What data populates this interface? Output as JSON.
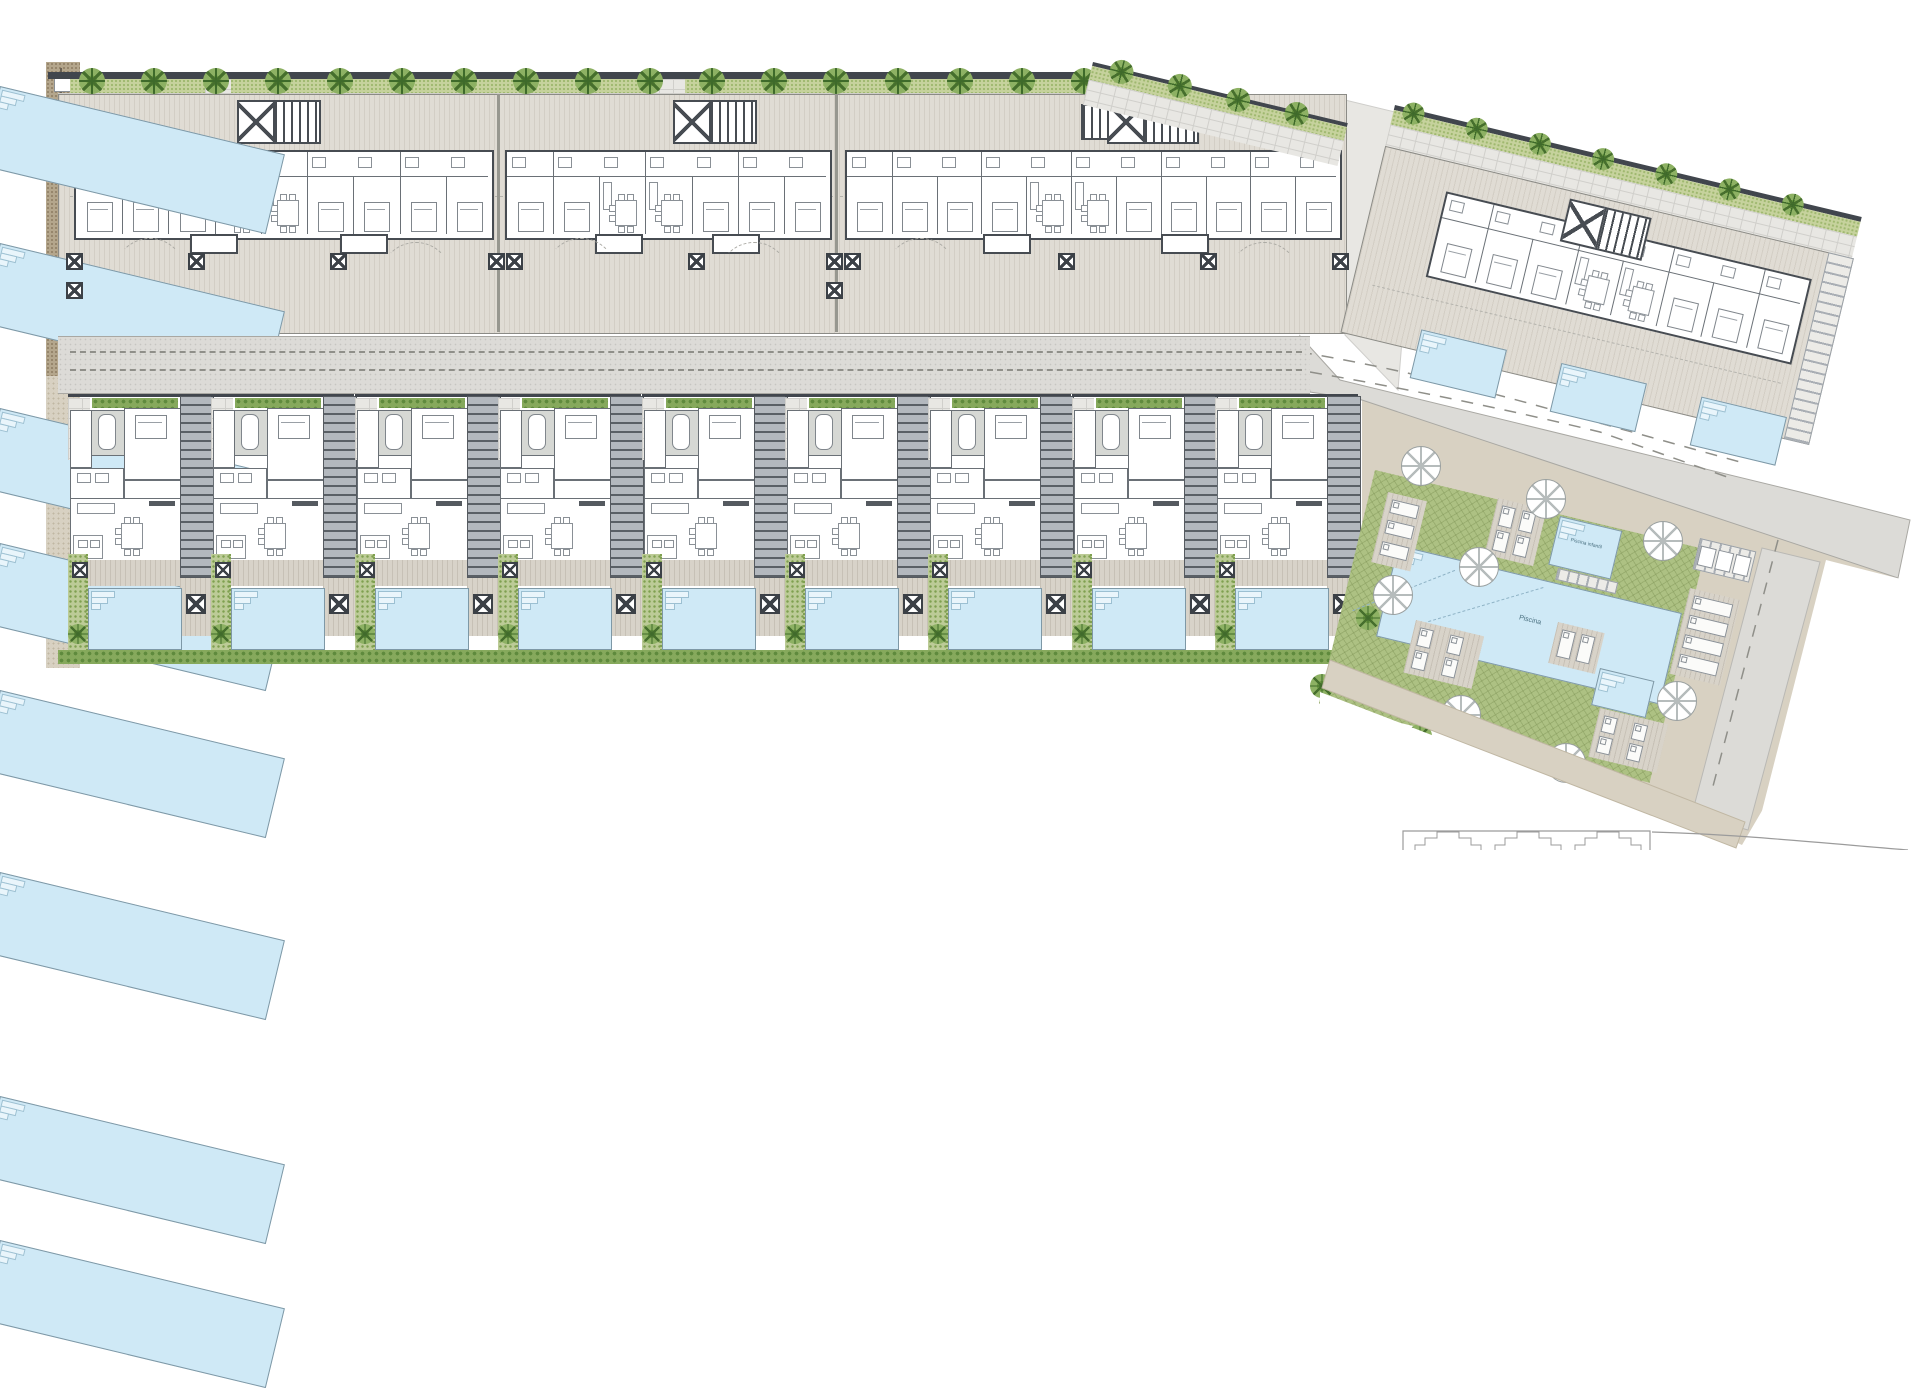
{
  "plan": {
    "type": "architectural-site-plan",
    "colors": {
      "wall": "#41464d",
      "hedge": "#c6d29d",
      "hedge_dark": "#5f8a3d",
      "paving": "#e8e7e3",
      "terrace": "#e0dcd4",
      "deck": "#d8d3c9",
      "road": "#dcdbd7",
      "gravel": "#b4a68c",
      "path_beige": "#d8d1c2",
      "lawn": "#adc183",
      "garden": "#bccb97",
      "pool_water": "#cfe9f6",
      "slab_line": "#474c52"
    },
    "labels": {
      "main_pool": "Piscina",
      "kids_pool": "Piscina infantil"
    },
    "top_edge": {
      "wall": [
        48,
        72,
        1054,
        7
      ],
      "hedge": [
        70,
        79,
        1032,
        14
      ],
      "sidewalk": [
        58,
        93,
        1046,
        19
      ],
      "tree_start_x": 92,
      "tree_step": 62,
      "tree_count": 17,
      "hedge_gaps": [
        [
          205,
          26
        ],
        [
          645,
          40
        ]
      ]
    },
    "sloped_edge": {
      "x": 1093,
      "y": 62,
      "len": 262,
      "angle": 13.5,
      "trees": [
        30,
        90,
        150,
        210
      ]
    },
    "left_edge": {
      "gravel": [
        46,
        62,
        34,
        314
      ],
      "path": [
        46,
        376,
        34,
        292
      ],
      "gate": [
        54,
        76,
        20,
        14
      ]
    },
    "top_row": {
      "band": [
        58,
        94,
        1287,
        238
      ],
      "dividers": [
        497,
        835
      ],
      "guide_y": 196,
      "blocks": [
        {
          "slab": [
            74,
            150,
            416,
            86
          ],
          "core": [
            237,
            100
          ],
          "pools": [
            86,
            243,
            408
          ],
          "wide_core": false
        },
        {
          "slab": [
            505,
            150,
            323,
            86
          ],
          "core": [
            673,
            100
          ],
          "pools": [
            543,
            690
          ],
          "wide_core": false
        },
        {
          "slab": [
            845,
            150,
            493,
            86
          ],
          "core": [
            1107,
            100
          ],
          "pools": [
            872,
            1096,
            1240
          ],
          "wide_core": true
        }
      ],
      "pool_y": 291,
      "pool_w": 80,
      "pool_h": 38,
      "columns_y": 253,
      "columns": [
        66,
        188,
        330,
        488,
        506,
        688,
        826,
        844,
        1058,
        1200,
        1332
      ]
    },
    "road": {
      "rect": [
        58,
        336,
        1252,
        56
      ],
      "dash_y": [
        351,
        369
      ]
    },
    "townhouses": {
      "x0": 68,
      "pitch": 143.4,
      "count": 9,
      "y": 394,
      "h": 274,
      "bottom_hedge": [
        58,
        650,
        1274,
        14
      ]
    },
    "right_plot": {
      "x": 1395,
      "y": 105,
      "w": 480,
      "h": 280,
      "angle": 13.5,
      "trees": [
        20,
        85,
        150,
        215,
        280,
        345,
        410
      ],
      "core": [
        192,
        50
      ],
      "slab": [
        70,
        72,
        372,
        84
      ],
      "pools": [
        [
          78,
          212
        ],
        [
          222,
          212
        ],
        [
          366,
          212
        ]
      ],
      "pool_w": 86,
      "pool_h": 48,
      "ladder": [
        456,
        42,
        24,
        190
      ]
    },
    "communal": {
      "angle": 13.5,
      "green": [
        1375,
        470,
        340,
        240
      ],
      "big_pool": [
        1398,
        545,
        290,
        92
      ],
      "kids_pool": [
        1560,
        516,
        62,
        48
      ],
      "spa_pool": [
        1600,
        668,
        54,
        36
      ],
      "steps": [
        1558,
        568,
        60,
        10
      ],
      "decks": [
        [
          1388,
          492,
          40,
          72,
          3,
          1
        ],
        [
          1498,
          498,
          50,
          58,
          2,
          2
        ],
        [
          1690,
          588,
          52,
          88,
          4,
          1
        ],
        [
          1416,
          620,
          70,
          54,
          2,
          2
        ],
        [
          1600,
          708,
          70,
          50,
          2,
          2
        ],
        [
          1558,
          622,
          48,
          42,
          1,
          2
        ]
      ],
      "umbrellas": [
        [
          1420,
          465
        ],
        [
          1545,
          498
        ],
        [
          1662,
          540
        ],
        [
          1478,
          566
        ],
        [
          1392,
          594
        ],
        [
          1460,
          714
        ],
        [
          1676,
          700
        ],
        [
          1565,
          762
        ]
      ],
      "palms": [
        [
          1368,
          618
        ],
        [
          1322,
          686
        ],
        [
          1420,
          736
        ]
      ],
      "benches": [
        1700,
        538
      ]
    }
  }
}
